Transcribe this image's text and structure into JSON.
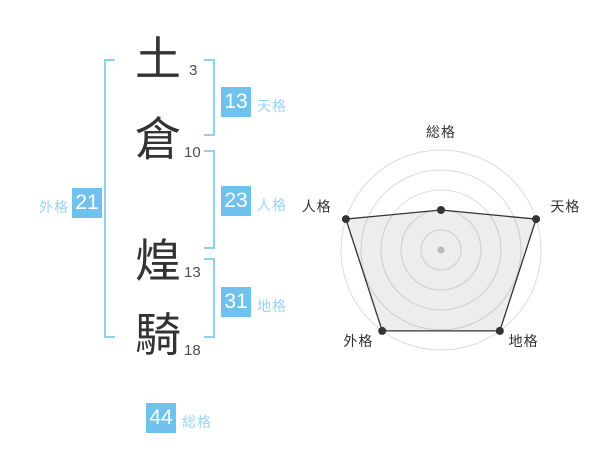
{
  "name": {
    "surname": [
      {
        "char": "土",
        "strokes": "3"
      },
      {
        "char": "倉",
        "strokes": "10"
      }
    ],
    "given": [
      {
        "char": "煌",
        "strokes": "13"
      },
      {
        "char": "騎",
        "strokes": "18"
      }
    ]
  },
  "kaku": {
    "tenkaku": {
      "label": "天格",
      "value": "13"
    },
    "jinkaku": {
      "label": "人格",
      "value": "23"
    },
    "chikaku": {
      "label": "地格",
      "value": "31"
    },
    "gaikaku": {
      "label": "外格",
      "value": "21"
    },
    "soukaku": {
      "label": "総格",
      "value": "44"
    }
  },
  "colors": {
    "accent": "#6fc2ee",
    "accent_light": "#9bd4f5",
    "bracket": "#8fd0f3",
    "text_dark": "#333333",
    "text_gray": "#4f4f4f",
    "chart_ring": "#dcdcdc",
    "chart_line": "#333333",
    "chart_fill": "rgba(0,0,0,0.07)",
    "chart_center_dot": "#c9c9c9",
    "background": "#ffffff"
  },
  "chart_data": {
    "type": "radar",
    "categories": [
      "総格",
      "天格",
      "地格",
      "外格",
      "人格"
    ],
    "values": [
      2,
      5,
      5,
      5,
      5
    ],
    "max": 5,
    "rings": 5,
    "start": "top",
    "direction": "clockwise",
    "grid": "concentric-circles",
    "spokes": false,
    "legend_position": "none",
    "point_color": "#333333",
    "center_dot_color": "#c9c9c9"
  }
}
